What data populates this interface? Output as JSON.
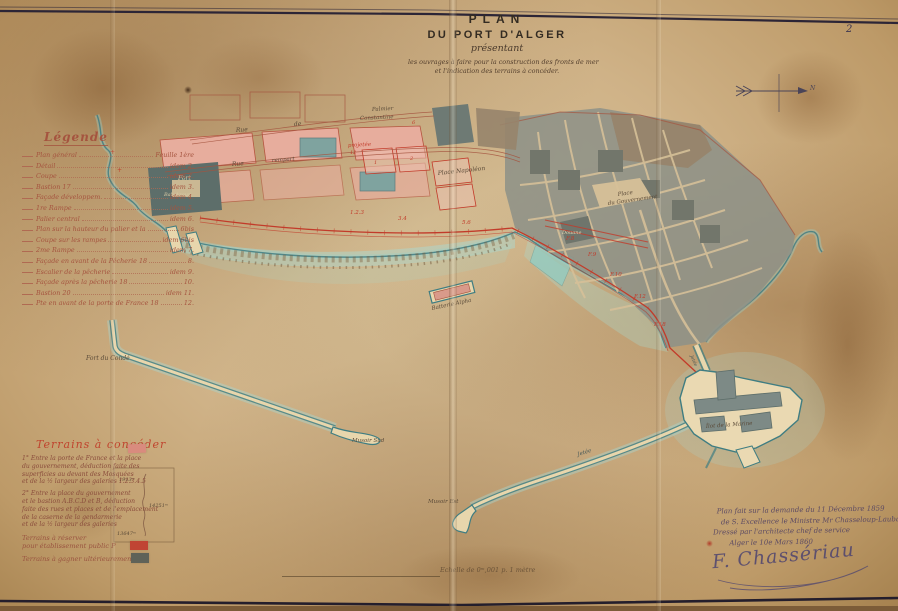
{
  "page": {
    "number": "2"
  },
  "title": {
    "line1": "PLAN",
    "line2": "DU PORT D'ALGER",
    "line3": "présentant",
    "line4": "les ouvrages à faire pour la construction des fronts de mer",
    "line5": "et l'indication des terrains à concéder."
  },
  "compass": {
    "north_label": "N"
  },
  "legend": {
    "heading": "Légende",
    "items": [
      {
        "label": "Plan général",
        "ref": "Feuille 1ère"
      },
      {
        "label": "Détail",
        "ref": "idem 2."
      },
      {
        "label": "Coupe",
        "ref": "idem 2."
      },
      {
        "label": "Bastion 17",
        "ref": "idem 3."
      },
      {
        "label": "Façade développem.",
        "ref": "idem 4."
      },
      {
        "label": "1re Rampe",
        "ref": "idem 5."
      },
      {
        "label": "Palier central",
        "ref": "idem 6."
      },
      {
        "label": "Plan sur la hauteur du palier et la",
        "ref": "6bis"
      },
      {
        "label": "Coupe sur les rampes",
        "ref": "idem 6bis"
      },
      {
        "label": "2me Rampe",
        "ref": "idem 7."
      },
      {
        "label": "Façade en avant de la Pêcherie 18",
        "ref": "8."
      },
      {
        "label": "Escalier de la pêcherie",
        "ref": "idem 9."
      },
      {
        "label": "Façade après la pêcherie 18",
        "ref": "10."
      },
      {
        "label": "Bastion 20",
        "ref": "idem 11."
      },
      {
        "label": "Pte en avant de la porte de France 18",
        "ref": "12."
      }
    ]
  },
  "map_labels": {
    "fort": "Fort",
    "bab_azoun": "Bab-Azoun",
    "rue1": "Rue",
    "de1": "de",
    "palmier": "Palmier",
    "constantine": "Constantine",
    "rue2": "Rue",
    "rempart": "rempart",
    "projetee": "projetée",
    "place_napoleon": "Place Napoléon",
    "place_gouv1": "Place",
    "place_gouv2": "du Gouvernement",
    "douane": "Douane",
    "batterie": "Batterie Alpha",
    "fort_conde": "Fort du Condé",
    "musoir_sud": "Musoir Sud",
    "musoir_est": "Musoir Est",
    "jetee": "Jetée",
    "ilot_marine": "Îlot de la Marine",
    "refs": {
      "r1": "1.2.3",
      "r2": "3.4",
      "r3": "5.6",
      "r4": "F.8",
      "r5": "F.9",
      "r6": "F.10",
      "r7": "F.12",
      "r8": "F.18"
    },
    "parcels": {
      "p1": "1",
      "p2": "2",
      "p3": "6",
      "p4": "12"
    }
  },
  "concessions": {
    "heading": "Terrains à concéder",
    "para1": "1° Entre la porte de France et la place\ndu gouvernement, déduction faite des\nsuperficies au devant des Mosquées\net de la ½ largeur des galeries 1.2.3.4.5",
    "para2": "2° Entre la place du gouvernement\net le bastion A.B.C.D et B, déduction\nfaite des rues et places et de l'emplacement\nde la caserne de la gendarmerie\net de la ½ largeur des galeries",
    "reserve": "Terrains à réserver\npour établissement public P",
    "gain": "Terrains à gagner ultérieurement",
    "diagram": {
      "v1": "1913ᵐ",
      "v2": "14251ᵐ",
      "v3": "13647ᵐ"
    }
  },
  "dedication": {
    "line1": "Plan fait sur la demande du 11 Décembre 1859",
    "line2": "de S. Excellence le Ministre Mr Chasseloup-Laubat",
    "line3": "Dressé par l'architecte chef de service",
    "line4": "Alger le 10e Mars 1860",
    "signature": "F. Chassériau"
  },
  "scale": {
    "text": "Echelle de 0ᵐ,001 p. 1 mètre"
  },
  "colors": {
    "paper": "#cdae7f",
    "ink_red": "#c23b2a",
    "ink_legend": "#a5543f",
    "ink_hand": "#5a4a38",
    "teal_coast": "#3f7d82",
    "water": "#a8dcd4",
    "block_gray": "#8e9287",
    "block_pink": "#e7ad9d",
    "swatch_concede": "#d98b7e",
    "swatch_reserve": "#c04433",
    "swatch_gain": "#5f6258"
  }
}
